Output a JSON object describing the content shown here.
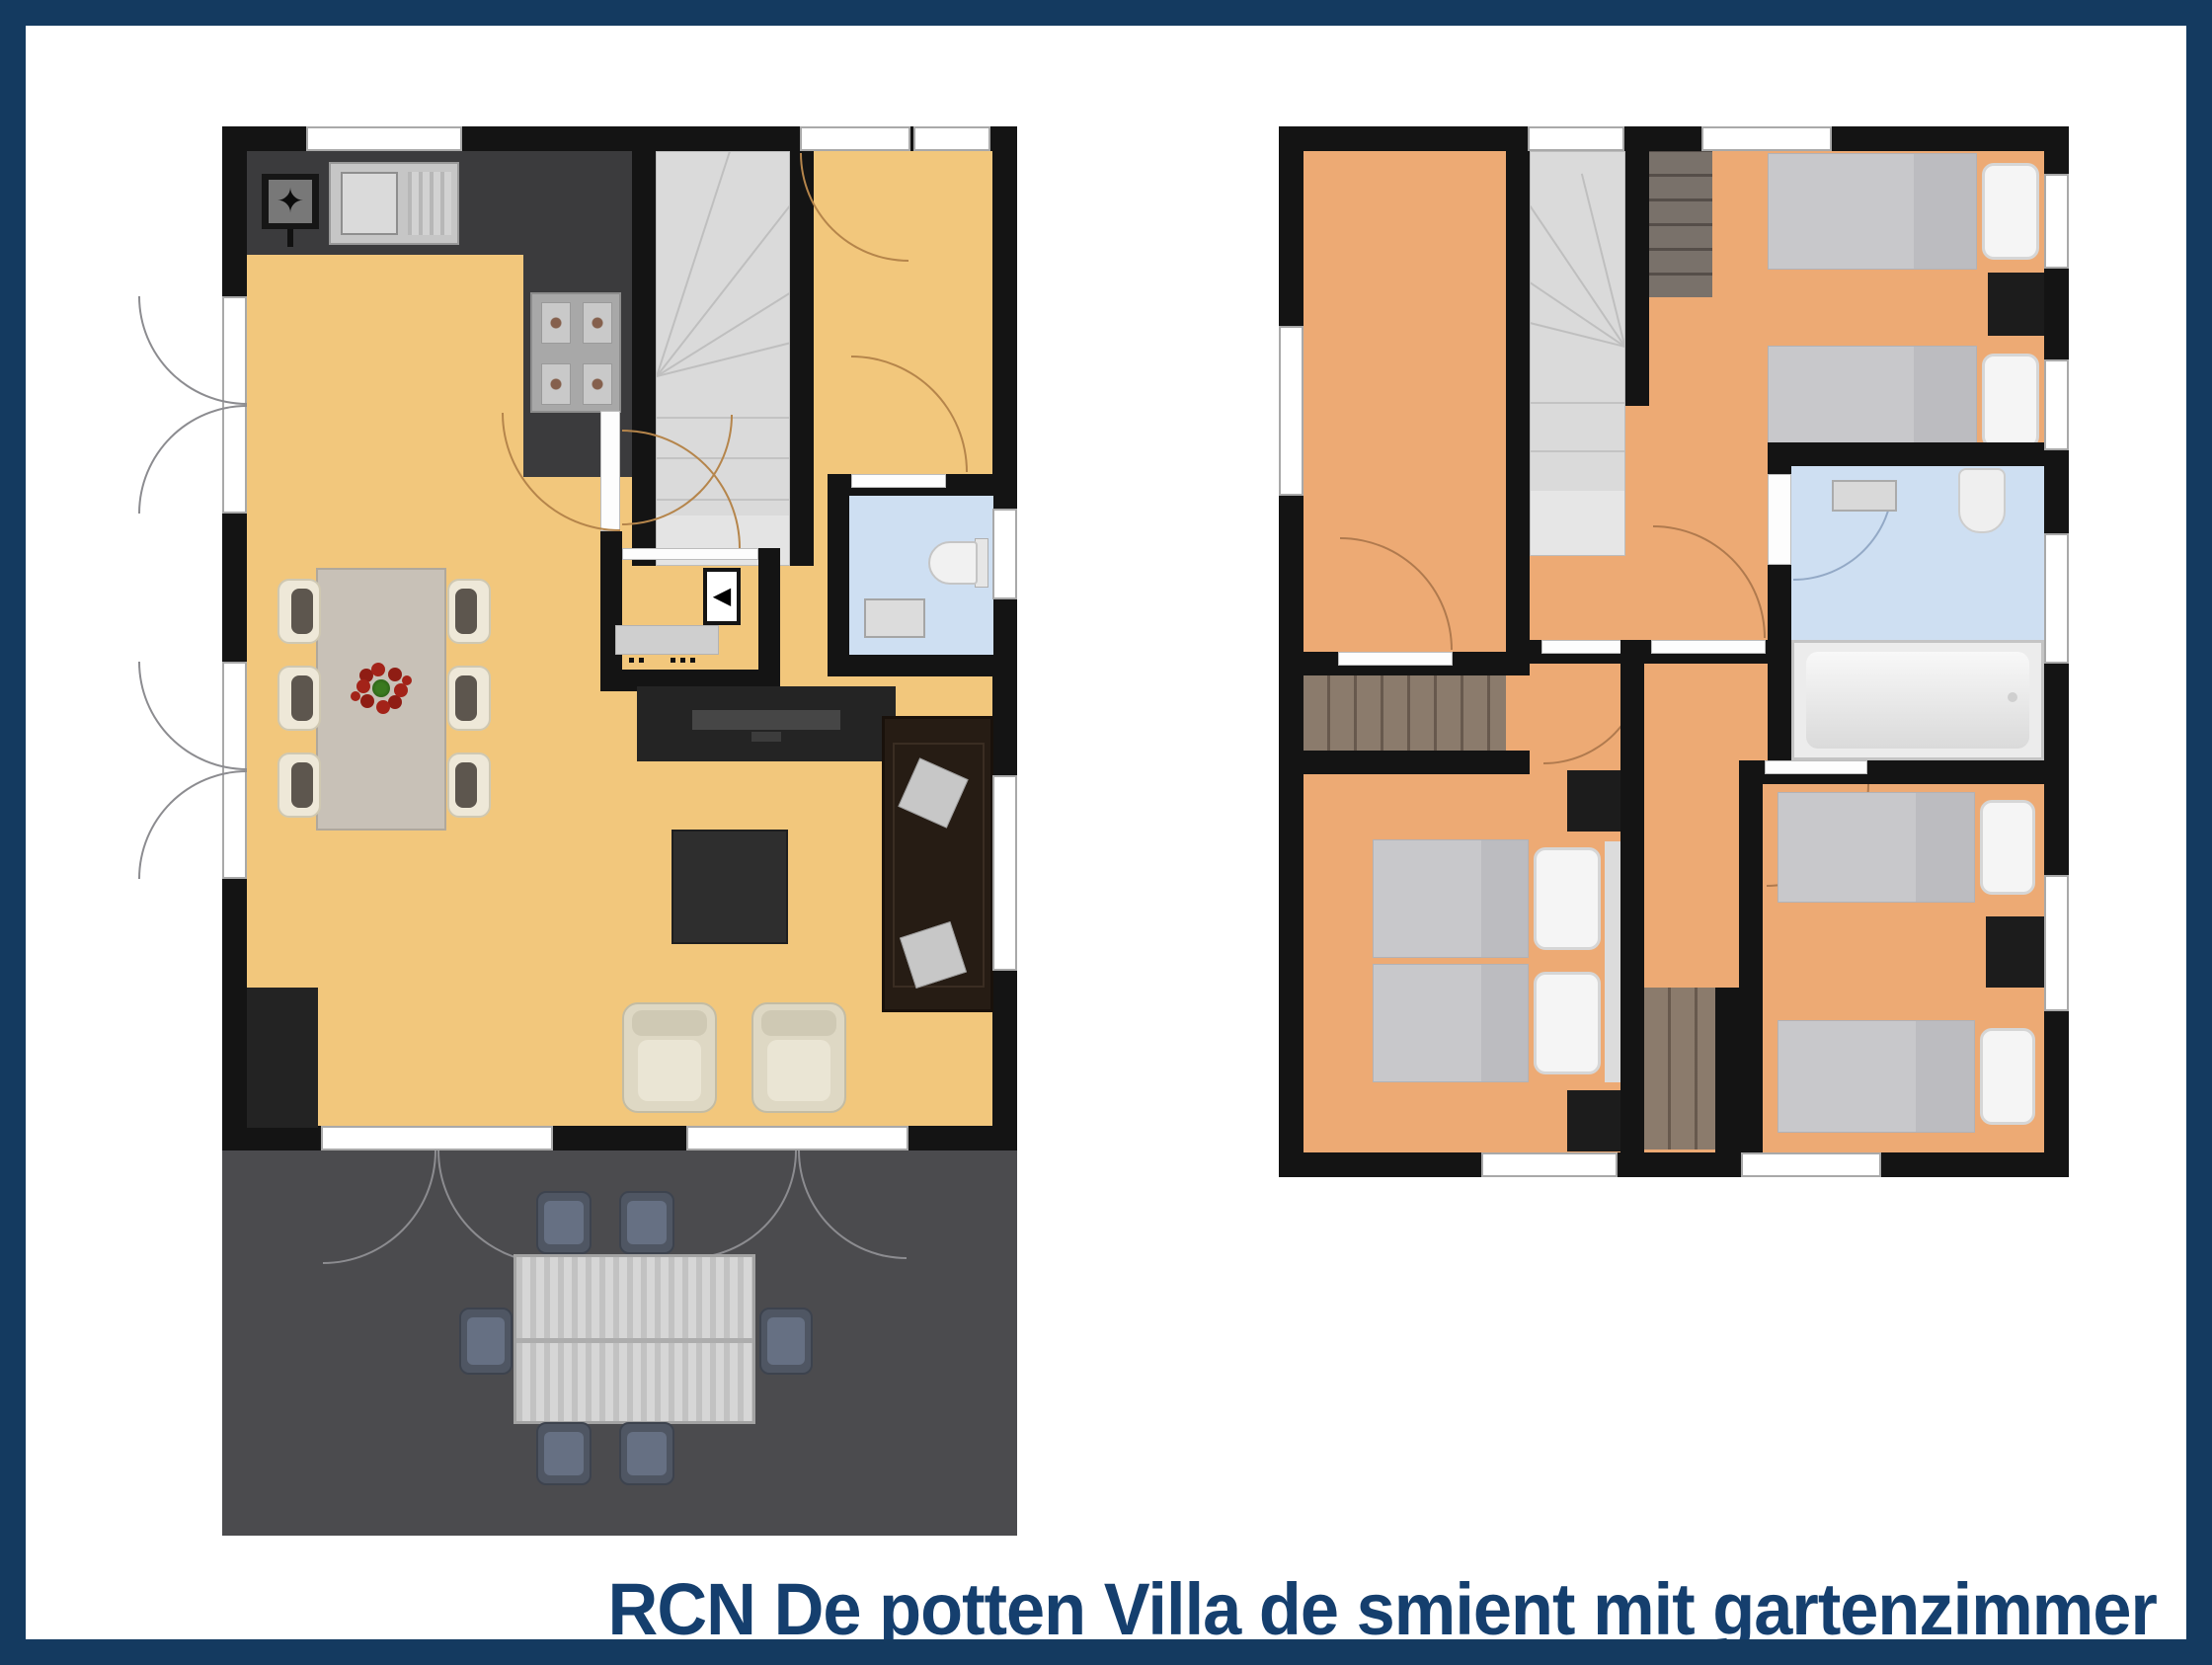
{
  "caption": {
    "text": "RCN De potten Villa de smient mit gartenzimmer"
  },
  "glyphs": {
    "fridge_star": "✦",
    "washer_arrow": "◀"
  },
  "colors": {
    "border_navy": "#143A60",
    "caption_text": "#153F6E",
    "wall": "#141414",
    "ground_floor": "#F2C77C",
    "upper_floor": "#EDAA74",
    "terrace": "#4B4B4E",
    "counter": "#3B3B3D",
    "bath_floor": "#CEDFF2",
    "stairs": "#DADADA",
    "wood": "#8B7B6C",
    "wood_dark": "#79716A",
    "mattress": "#C8C8CB",
    "pillow": "#F5F5F5",
    "nightstand": "#1C1C1C",
    "sofa": "#261C14",
    "armchair": "#DED8C4",
    "dining_table": "#C8C1B7",
    "outdoor_chair": "#4F5663",
    "tv_unit": "#242424",
    "door_arc_gold": "#B5854B",
    "door_arc_salmon": "#B07A4E",
    "door_arc_gray": "#8C8C90",
    "door_arc_blue": "#93A9C6",
    "flower_red": "#A32319",
    "flower_green": "#2F6D1C"
  },
  "ground_floor": {
    "label": "ground-floor-plan",
    "rooms": [
      "kitchen",
      "living-dining-room",
      "hallway",
      "wc",
      "utility-closet",
      "terrace"
    ],
    "furniture": [
      "fridge",
      "kitchen-sink",
      "stove-4-burners",
      "winder-staircase",
      "dining-table-with-6-chairs",
      "flower-centerpiece",
      "coffee-table",
      "corner-sofa",
      "tv-sideboard",
      "washing-machine",
      "toilet",
      "hand-basin",
      "two-armchairs",
      "outdoor-dining-table-with-6-chairs"
    ]
  },
  "upper_floor": {
    "label": "upper-floor-plan",
    "rooms": [
      "bedroom-1",
      "bedroom-2",
      "bedroom-3",
      "bedroom-4",
      "bathroom",
      "landing",
      "hallway"
    ],
    "furniture": [
      "winder-staircase",
      "built-in-wardrobe",
      "two-single-beds",
      "nightstand",
      "double-bed",
      "two-nightstands",
      "two-single-beds-2",
      "bathtub",
      "toilet",
      "washbasin"
    ]
  }
}
